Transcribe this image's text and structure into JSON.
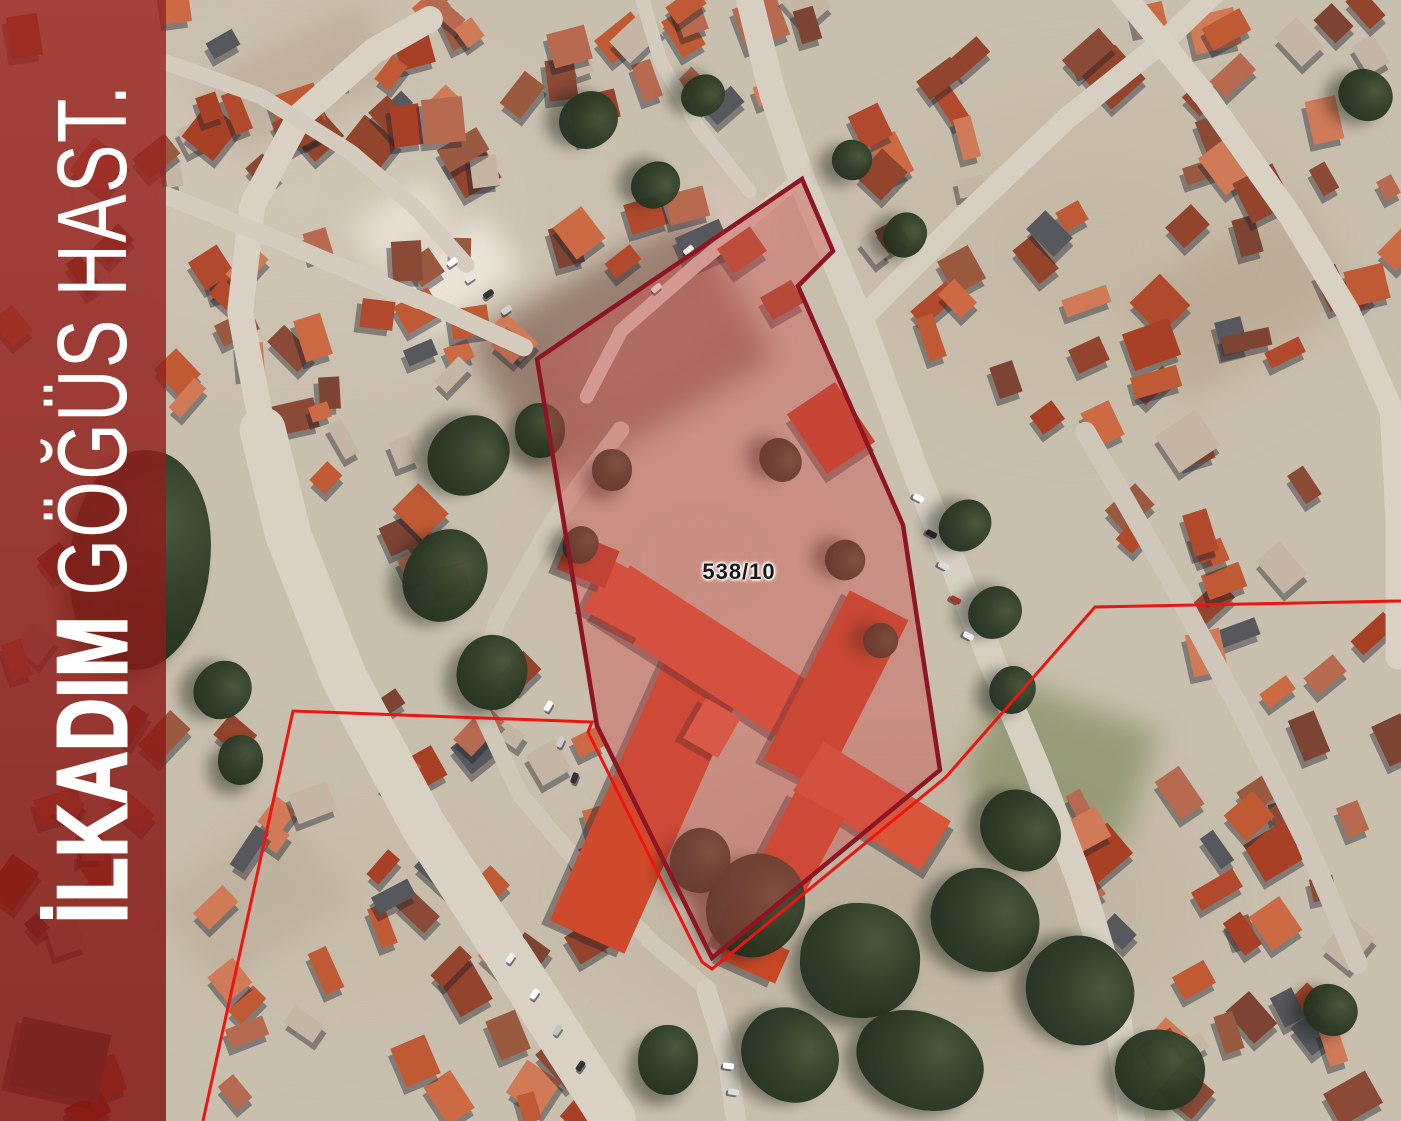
{
  "sidebar": {
    "label_bold": "İLKADIM",
    "label_light": "GÖĞÜS HAST.",
    "overlay_color": "rgba(148,24,18,0.81)"
  },
  "parcel": {
    "label": "538/10",
    "outline_color": "#8e1523",
    "fill_color": "rgba(206,72,70,0.40)"
  },
  "boundary_line": {
    "color": "#ef1312"
  }
}
